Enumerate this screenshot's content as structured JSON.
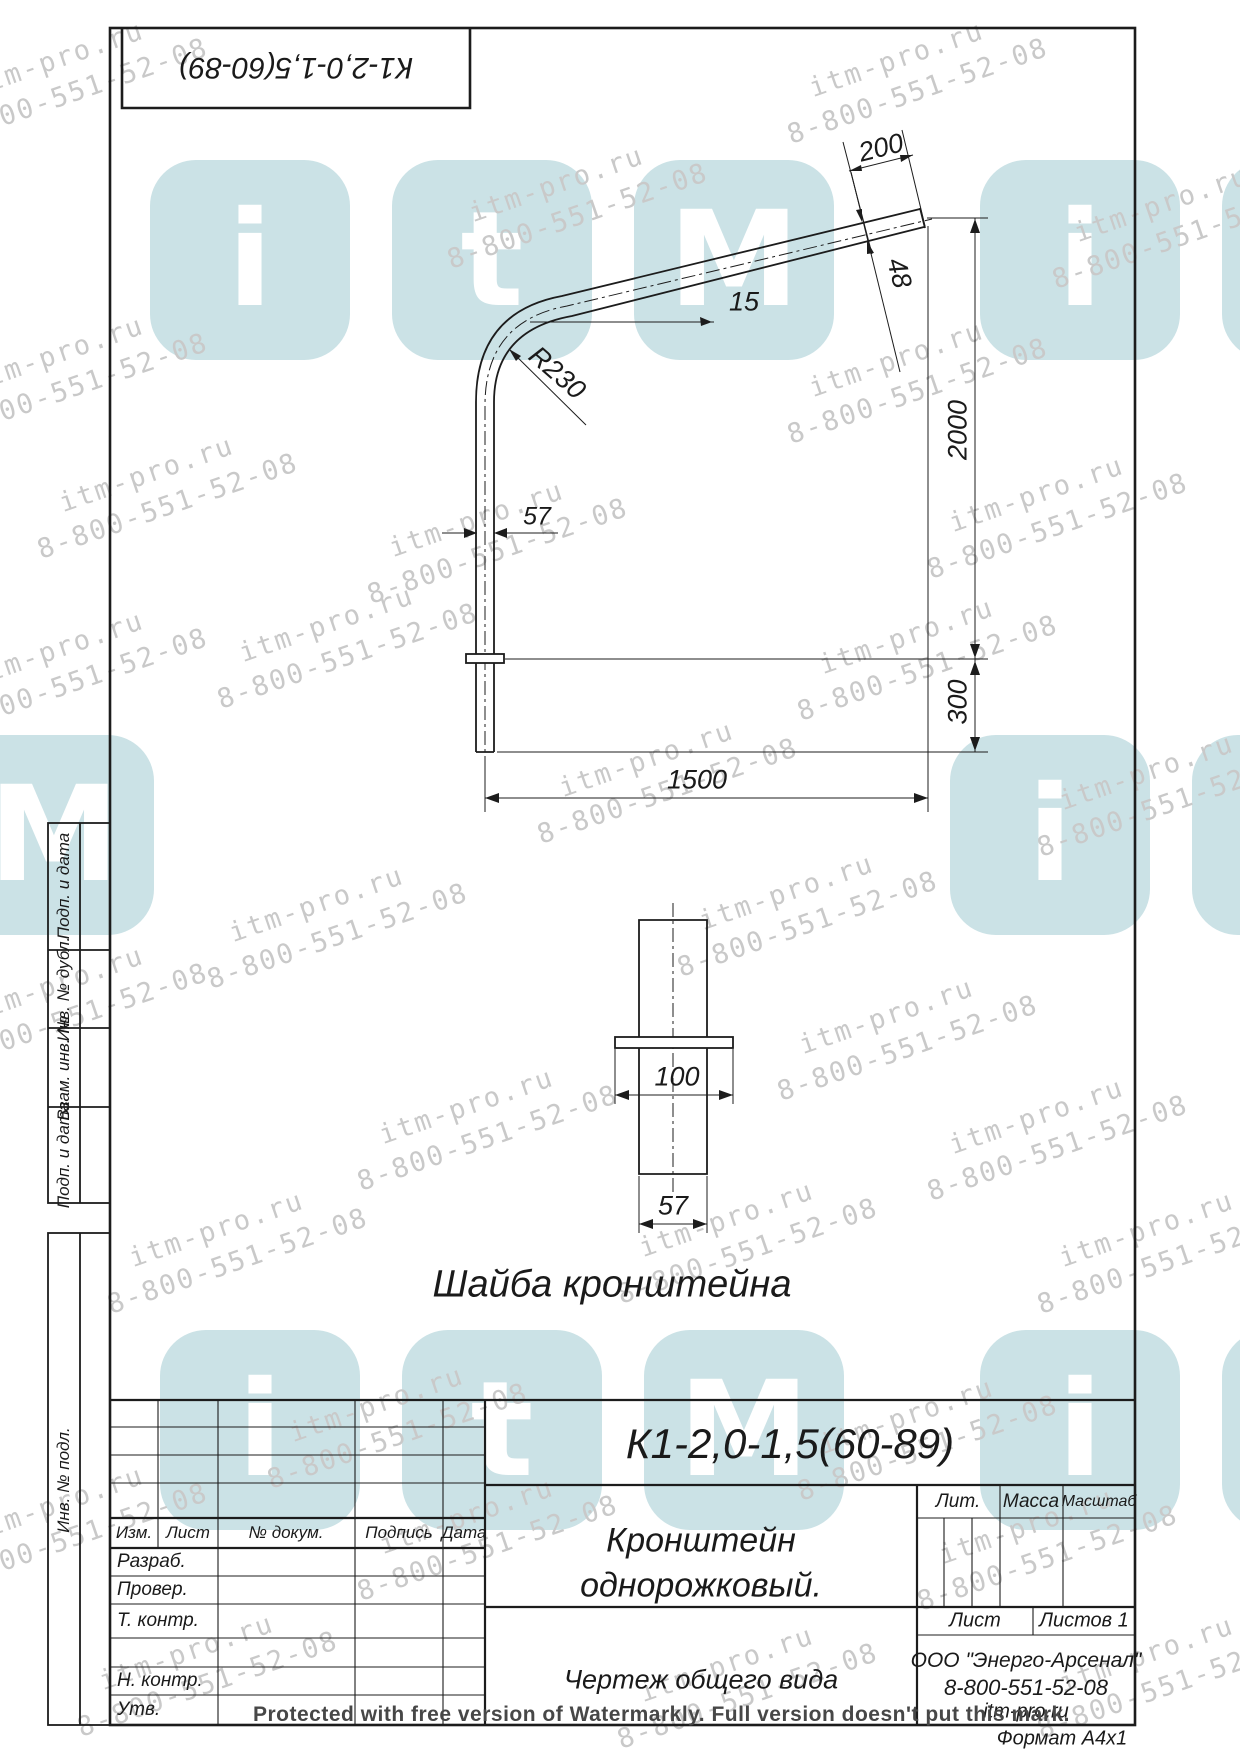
{
  "watermark": {
    "site": "itm-pro.ru",
    "phone": "8-800-551-52-08",
    "protected_line": "Protected with free version of Watermarkly. Full version doesn't put this mark.",
    "logo_letters": [
      "i",
      "t",
      "M"
    ]
  },
  "corner_stamp": {
    "code": "К1-2,0-1,5(60-89)"
  },
  "drawing": {
    "dims": {
      "arm_end_length": "200",
      "arm_end_diameter": "48",
      "arm_angle": "15",
      "bend_radius": "R230",
      "tube_diameter": "57",
      "height_to_end": "2000",
      "embed_depth": "300",
      "arm_reach": "1500"
    },
    "washer": {
      "label": "Шайба кронштейна",
      "flange_width": "100",
      "tube_diameter": "57"
    }
  },
  "title_block": {
    "code": "К1-2,0-1,5(60-89)",
    "name_line1": "Кронштейн",
    "name_line2": "однорожковый.",
    "doc_type": "Чертеж общего вида",
    "company": "ООО \"Энерго-Арсенал\"",
    "phone": "8-800-551-52-08",
    "site": "itm-pro.ru",
    "format": "Формат  А4х1",
    "headers": {
      "lit": "Лит.",
      "mass": "Масса",
      "scale": "Масштаб",
      "sheet": "Лист",
      "sheets": "Листов 1",
      "izm": "Изм.",
      "list": "Лист",
      "doc_num": "№ докум.",
      "sign": "Подпись",
      "date": "Дата"
    },
    "rows": {
      "razrab": "Разраб.",
      "prover": "Провер.",
      "t_contr": "Т. контр.",
      "n_contr": "Н. контр.",
      "utv": "Утв."
    }
  },
  "sidebar": {
    "labels": [
      "Подп. и дата",
      "Инв. № дубл.",
      "Взам. инв. №",
      "Подп. и дата",
      "Инв. № подл."
    ]
  }
}
